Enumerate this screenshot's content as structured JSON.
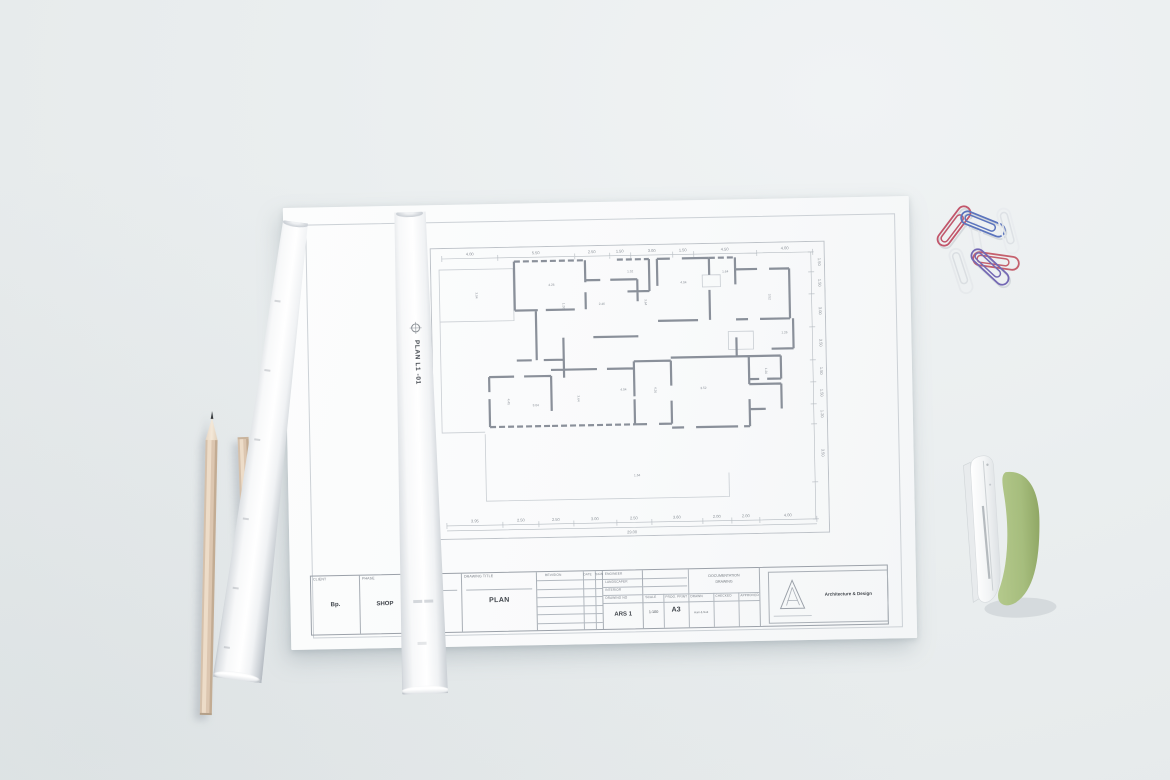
{
  "scene": {
    "background_color": "#e9edee",
    "objects": [
      "drawing-sheet",
      "rolled-drawing-left",
      "rolled-drawing-right",
      "pencil-left",
      "pencil-right",
      "paper-clips",
      "stapler"
    ]
  },
  "sheet": {
    "paper_color": "#fafbfc",
    "plan": {
      "dim_top": [
        "4.00",
        "5.50",
        "2.50",
        "1.50",
        "3.00",
        "1.50",
        "4.50",
        "4.00"
      ],
      "dim_bottom": [
        "3.95",
        "2.50",
        "2.50",
        "3.00",
        "2.50",
        "3.60",
        "2.00",
        "2.00",
        "4.00"
      ],
      "dim_bottom_total": "29.00",
      "dim_right": [
        "1.50",
        "1.50",
        "3.00",
        "3.50",
        "1.50",
        "1.50",
        "1.20",
        "3.50"
      ],
      "room_labels": [
        "3.04",
        "4.26",
        "1.26",
        "2.46",
        "1.52",
        "3.64",
        "4.04",
        "1.64",
        "3.52",
        "1.26",
        "4.45",
        "3.04",
        "3.64",
        "4.04",
        "4.26",
        "3.52",
        "1.26",
        "1.64"
      ]
    },
    "titleblock": {
      "client_label": "CLIENT",
      "client_value": "Bp.",
      "phase_label": "PHASE",
      "phase_value": "SHOP",
      "project_label": "PROJECT",
      "location_label": "LOCATION",
      "drawing_title_label": "DRAWING TITLE",
      "drawing_title_value": "PLAN",
      "revision_label": "REVISION",
      "date_label": "DATE",
      "sign_label": "SIGN",
      "engineer_label": "ENGINEER",
      "landscaper_label": "LANDSCAPER",
      "interior_label": "INTERIOR",
      "drawing_no_label": "DRAWING NO",
      "drawing_no_value": "ARS 1",
      "scale_label": "SCALE",
      "scale_value": "1:100",
      "prog_print_label": "PROG. PRINT",
      "prog_print_value": "A3",
      "drawn_label": "DRAWN",
      "drawn_value": "Hani & Nati",
      "checked_label": "CHECKED",
      "approved_label": "APPROVED",
      "documentation_label_1": "DOCUMENTATION",
      "documentation_label_2": "DRAWING",
      "company_name": "Architecture & Design"
    }
  },
  "rolls": {
    "label": "PLAN L1 -01"
  },
  "stationery": {
    "pencil_wood": "#e3d0bd",
    "paperclip_colors": [
      "#c2566b",
      "#5b74bd",
      "#e9ecef",
      "#e6e9ec",
      "#7468b4",
      "#c5606d",
      "#eef0f3"
    ],
    "stapler_green": "#a6bd7d",
    "stapler_white": "#f2f4f5"
  }
}
